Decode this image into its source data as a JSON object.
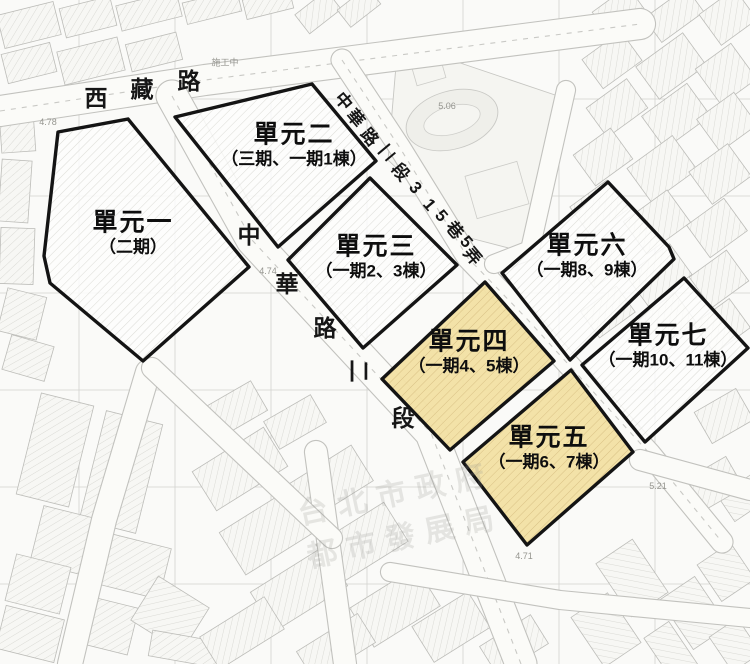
{
  "map": {
    "units": [
      {
        "id": "unit-1",
        "name": "單元一",
        "subtitle": "（二期）",
        "highlighted": false,
        "label": {
          "x": 133,
          "y": 234
        },
        "polygon": "58,132 128,119 249,267 143,361 50,283 44,256"
      },
      {
        "id": "unit-2",
        "name": "單元二",
        "subtitle": "（三期、一期1棟）",
        "highlighted": false,
        "label": {
          "x": 294,
          "y": 146
        },
        "polygon": "312,84 376,161 278,247 175,117"
      },
      {
        "id": "unit-3",
        "name": "單元三",
        "subtitle": "（一期2、3棟）",
        "highlighted": false,
        "label": {
          "x": 376,
          "y": 258
        },
        "polygon": "370,178 457,265 363,348 288,260"
      },
      {
        "id": "unit-4",
        "name": "單元四",
        "subtitle": "（一期4、5棟）",
        "highlighted": true,
        "label": {
          "x": 469,
          "y": 353
        },
        "polygon": "485,282 554,361 450,450 382,379"
      },
      {
        "id": "unit-5",
        "name": "單元五",
        "subtitle": "（一期6、7棟）",
        "highlighted": true,
        "label": {
          "x": 549,
          "y": 449
        },
        "polygon": "571,370 633,452 527,545 463,462"
      },
      {
        "id": "unit-6",
        "name": "單元六",
        "subtitle": "（一期8、9棟）",
        "highlighted": false,
        "label": {
          "x": 587,
          "y": 257
        },
        "polygon": "608,182 669,247 674,259 570,360 502,273"
      },
      {
        "id": "unit-7",
        "name": "單元七",
        "subtitle": "（一期10、11棟）",
        "highlighted": false,
        "label": {
          "x": 668,
          "y": 347
        },
        "polygon": "684,278 748,348 645,442 582,365"
      }
    ],
    "road_labels": {
      "xizang": {
        "name": "西藏路",
        "size": 23,
        "chars": [
          {
            "c": "西",
            "x": 96,
            "y": 96,
            "r": 0
          },
          {
            "c": "藏",
            "x": 142,
            "y": 87,
            "r": 0
          },
          {
            "c": "路",
            "x": 189,
            "y": 79,
            "r": 0
          }
        ]
      },
      "zhonghua": {
        "name": "中華路二段",
        "size": 23,
        "chars": [
          {
            "c": "中",
            "x": 249,
            "y": 233,
            "r": 0
          },
          {
            "c": "華",
            "x": 287,
            "y": 282,
            "r": 0
          },
          {
            "c": "路",
            "x": 325,
            "y": 326,
            "r": 0
          },
          {
            "c": "二",
            "x": 361,
            "y": 371,
            "r": 90
          },
          {
            "c": "段",
            "x": 403,
            "y": 416,
            "r": 0
          }
        ]
      },
      "lane315": {
        "name": "中華路二段315巷5弄",
        "size": 17,
        "chars": [
          {
            "c": "中",
            "x": 345,
            "y": 100,
            "r": 50
          },
          {
            "c": "華",
            "x": 357,
            "y": 117,
            "r": 50
          },
          {
            "c": "路",
            "x": 371,
            "y": 136,
            "r": 50
          },
          {
            "c": "二",
            "x": 388,
            "y": 154,
            "r": 140
          },
          {
            "c": "段",
            "x": 402,
            "y": 171,
            "r": 50
          },
          {
            "c": "3",
            "x": 415,
            "y": 188,
            "r": 50
          },
          {
            "c": "1",
            "x": 429,
            "y": 205,
            "r": 50
          },
          {
            "c": "5",
            "x": 441,
            "y": 216,
            "r": 50
          },
          {
            "c": "巷",
            "x": 456,
            "y": 229,
            "r": 50
          },
          {
            "c": "5",
            "x": 466,
            "y": 242,
            "r": 50
          },
          {
            "c": "弄",
            "x": 474,
            "y": 255,
            "r": 50
          }
        ]
      }
    },
    "annotations": [
      {
        "text": "施工中",
        "x": 225,
        "y": 62
      },
      {
        "text": "4.78",
        "x": 48,
        "y": 122
      },
      {
        "text": "4.74",
        "x": 268,
        "y": 271
      },
      {
        "text": "5.06",
        "x": 447,
        "y": 106
      },
      {
        "text": "5.21",
        "x": 658,
        "y": 486
      },
      {
        "text": "4.71",
        "x": 524,
        "y": 556
      }
    ],
    "watermark": {
      "lines": [
        "台北市政府",
        "都市發展局"
      ],
      "x": 294,
      "y": 494,
      "rotation": -12
    },
    "colors": {
      "highlight_fill": "#F3E1A5",
      "highlight_hatch": "#D9C185",
      "unit_outline": "#141414",
      "map_line": "#C8C8C4"
    }
  }
}
